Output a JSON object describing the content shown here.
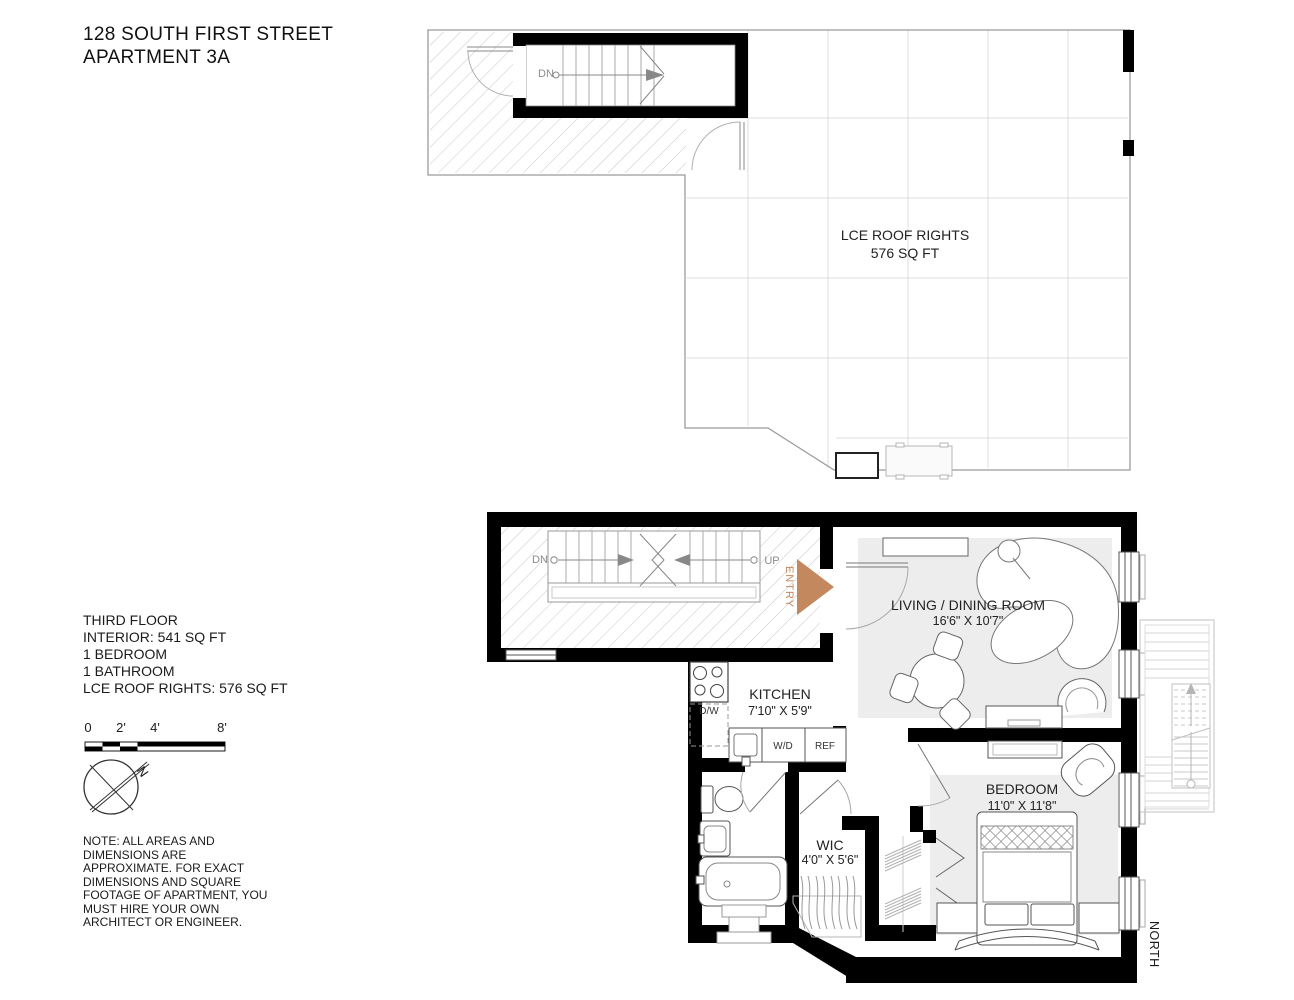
{
  "title": {
    "line1": "128 SOUTH FIRST STREET",
    "line2": "APARTMENT 3A"
  },
  "roof_plan": {
    "area_label": "LCE ROOF RIGHTS",
    "area_value": "576 SQ FT",
    "stair_down": "DN"
  },
  "floor_plan": {
    "stair_down": "DN",
    "stair_up": "UP",
    "entry_label": "ENTRY",
    "north_label": "NORTH",
    "living_room": {
      "name": "LIVING / DINING ROOM",
      "dims": "16'6\" X 10'7\""
    },
    "kitchen": {
      "name": "KITCHEN",
      "dims": "7'10\" X 5'9\""
    },
    "bedroom": {
      "name": "BEDROOM",
      "dims": "11'0\" X 11'8\""
    },
    "wic": {
      "name": "WIC",
      "dims": "4'0\" X 5'6\""
    },
    "dishwasher": "D/W",
    "washer_dryer": "W/D",
    "refrigerator": "REF"
  },
  "legend": {
    "floor_info_lines": [
      "THIRD FLOOR",
      "INTERIOR: 541 SQ FT",
      "1 BEDROOM",
      "1 BATHROOM",
      "LCE ROOF RIGHTS: 576 SQ FT"
    ],
    "scale_ticks": [
      "0",
      "2'",
      "4'",
      "8'"
    ],
    "compass_letter": "N",
    "note_lines": [
      "NOTE: ALL AREAS AND",
      "DIMENSIONS ARE",
      "APPROXIMATE. FOR EXACT",
      "DIMENSIONS AND SQUARE",
      "FOOTAGE OF APARTMENT, YOU",
      "MUST HIRE YOUR OWN",
      "ARCHITECT OR ENGINEER."
    ]
  },
  "colors": {
    "wall": "#000000",
    "entry_accent": "#c4885e",
    "rug": "#ededed",
    "hatch": "#c9c9c9",
    "grid": "#dcdcdc"
  }
}
